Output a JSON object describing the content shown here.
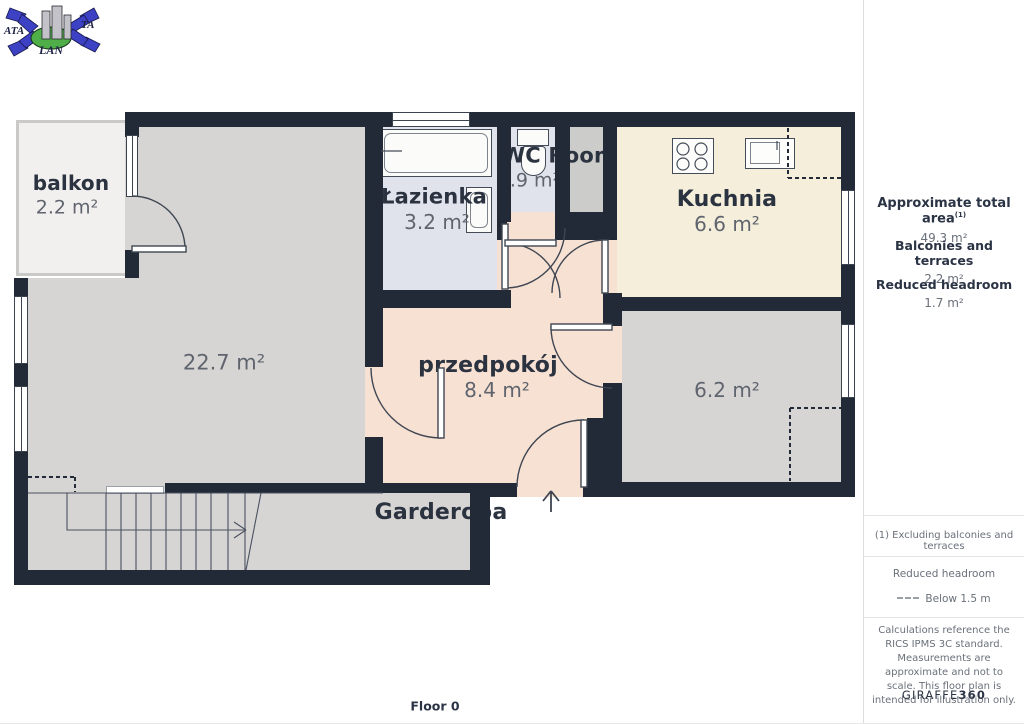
{
  "logo": {
    "text_left": "ATA",
    "text_right": "TA",
    "text_bottom": "LAN"
  },
  "floor_label": "Floor 0",
  "rooms": {
    "balkon": {
      "name": "balkon",
      "area": "2.2 m²"
    },
    "living": {
      "area": "22.7 m²"
    },
    "lazienka": {
      "name": "Łazienka",
      "area": "3.2 m²"
    },
    "wc": {
      "name": "WC Room",
      "area": "0.9 m²"
    },
    "kuchnia": {
      "name": "Kuchnia",
      "area": "6.6 m²"
    },
    "przedpokoj": {
      "name": "przedpokój",
      "area": "8.4 m²"
    },
    "room62": {
      "area": "6.2 m²"
    },
    "garderoba": {
      "name": "Garderoba"
    }
  },
  "sidebar": {
    "total_area_label": "Approximate total area",
    "total_area_note": "(1)",
    "total_area_value": "49.3 m²",
    "balconies_label": "Balconies and terraces",
    "balconies_value": "2.2 m²",
    "reduced_label": "Reduced headroom",
    "reduced_value": "1.7 m²",
    "footnote": "(1) Excluding balconies and terraces",
    "legend_title": "Reduced headroom",
    "legend_value": "Below 1.5 m",
    "disclaimer": "Calculations reference the RICS IPMS 3C standard. Measurements are approximate and not to scale. This floor plan is intended for illustration only.",
    "brand": "GIRAFFE",
    "brand_suffix": "360"
  },
  "colors": {
    "wall": "#222a38",
    "floor_gray": "#d6d5d3",
    "floor_blue": "#e0e3ec",
    "floor_cream": "#f4eedb",
    "floor_peach": "#f7e1d3",
    "floor_balcony": "#f1f0ee",
    "shaft_gray": "#ccccca",
    "name_text": "#2b3240",
    "area_text": "#5f646e",
    "logo_blue": "#3d41c4",
    "logo_green": "#4fae48"
  }
}
